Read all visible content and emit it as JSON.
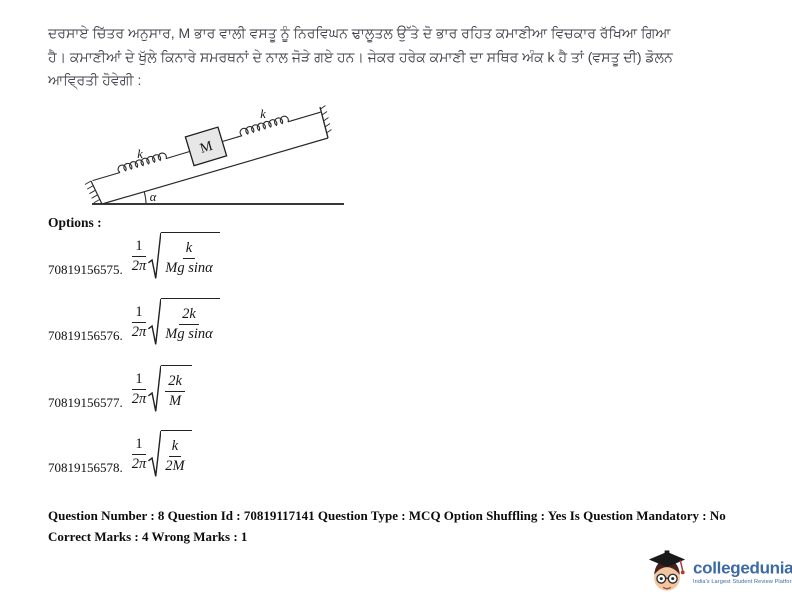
{
  "question": {
    "line1": "ਦਰਸਾਏ ਚਿੱਤਰ ਅਨੁਸਾਰ, M ਭਾਰ ਵਾਲੀ ਵਸਤੂ ਨੂੰ ਨਿਰਵਿਘਨ ਢਾਲੂਤਲ ਉੱਤੇ ਦੋ ਭਾਰ ਰਹਿਤ ਕਮਾਣੀਆ ਵਿਚਕਾਰ ਰੱਖਿਆ ਗਿਆ",
    "line2": "ਹੈ। ਕਮਾਣੀਆਂ ਦੇ ਖੁੱਲੇ ਕਿਨਾਰੇ ਸਮਰਥਨਾਂ ਦੇ ਨਾਲ ਜੋੜੇ ਗਏ ਹਨ। ਜੇਕਰ ਹਰੇਕ ਕਮਾਣੀ ਦਾ ਸਥਿਰ ਅੰਕ k ਹੈ ਤਾਂ (ਵਸਤੂ ਦੀ) ਡੋਲਨ",
    "line3": "ਆਵ੍ਰਿਤੀ ਹੋਵੇਗੀ :"
  },
  "diagram": {
    "spring_label_lower": "k",
    "spring_label_upper": "k",
    "mass_label": "M",
    "angle_label": "α"
  },
  "options": {
    "heading": "Options :",
    "items": [
      {
        "id": "70819156575.",
        "coef_num": "1",
        "coef_den": "2π",
        "rad_num": "k",
        "rad_den": "Mg sinα"
      },
      {
        "id": "70819156576.",
        "coef_num": "1",
        "coef_den": "2π",
        "rad_num": "2k",
        "rad_den": "Mg sinα"
      },
      {
        "id": "70819156577.",
        "coef_num": "1",
        "coef_den": "2π",
        "rad_num": "2k",
        "rad_den": "M"
      },
      {
        "id": "70819156578.",
        "coef_num": "1",
        "coef_den": "2π",
        "rad_num": "k",
        "rad_den": "2M"
      }
    ]
  },
  "footer": {
    "line1": "Question Number : 8 Question Id : 70819117141 Question Type : MCQ Option Shuffling : Yes Is Question Mandatory : No",
    "line2": "Correct Marks : 4 Wrong Marks : 1"
  },
  "logo": {
    "brand": "collegedunia",
    "trademark": "®",
    "tagline": "India's Largest Student Review Platform",
    "brand_color": "#3b6aa5"
  }
}
